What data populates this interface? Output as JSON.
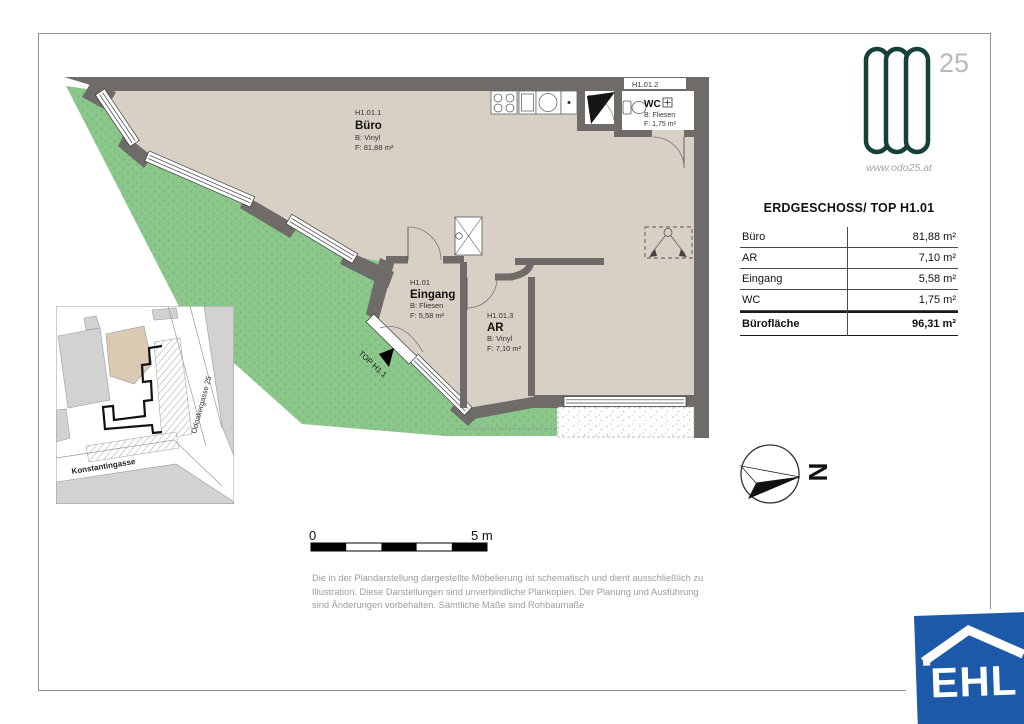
{
  "branding": {
    "logo_number": "25",
    "website": "www.odo25.at",
    "agency_logo_text": "EHL"
  },
  "plan": {
    "rooms": {
      "buero": {
        "id": "H1.01.1",
        "name": "Büro",
        "floor": "B: Vinyl",
        "area": "F: 81,88 m²"
      },
      "eingang": {
        "id": "H1.01",
        "name": "Eingang",
        "floor": "B: Fliesen",
        "area": "F: 5,58 m²"
      },
      "ar": {
        "id": "H1.01.3",
        "name": "AR",
        "floor": "B: Vinyl",
        "area": "F: 7,10 m²"
      },
      "wc": {
        "id": "H1.01.2",
        "name": "WC",
        "floor": "B: Fliesen",
        "area": "F: 1,75 m²"
      }
    },
    "entrance_label": "TOP H1.1",
    "north_letter": "N",
    "colors": {
      "wall": "#6f6b68",
      "floor": "#d8cfc5",
      "green": "#8bc78b"
    }
  },
  "area_table": {
    "title": "ERDGESCHOSS/ TOP H1.01",
    "rows": [
      {
        "label": "Büro",
        "value": "81,88 m²"
      },
      {
        "label": "AR",
        "value": "7,10 m²"
      },
      {
        "label": "Eingang",
        "value": "5,58 m²"
      },
      {
        "label": "WC",
        "value": "1,75 m²"
      }
    ],
    "total": {
      "label": "Bürofläche",
      "value": "96,31 m²"
    }
  },
  "site_map": {
    "street_bottom": "Konstantingasse",
    "street_right": "Odoakergasse 25"
  },
  "scale_bar": {
    "start_label": "0",
    "end_label": "5 m"
  },
  "disclaimer": "Die in der Plandarstellung dargestellte Möbelierung ist schematisch und dient ausschließlich zu Illustration. Diese Darstellungen sind unverbindliche Plankopien. Der Planung und Ausführung sind Änderungen vorbehalten. Sämtliche Maße sind Rohbaumaße"
}
